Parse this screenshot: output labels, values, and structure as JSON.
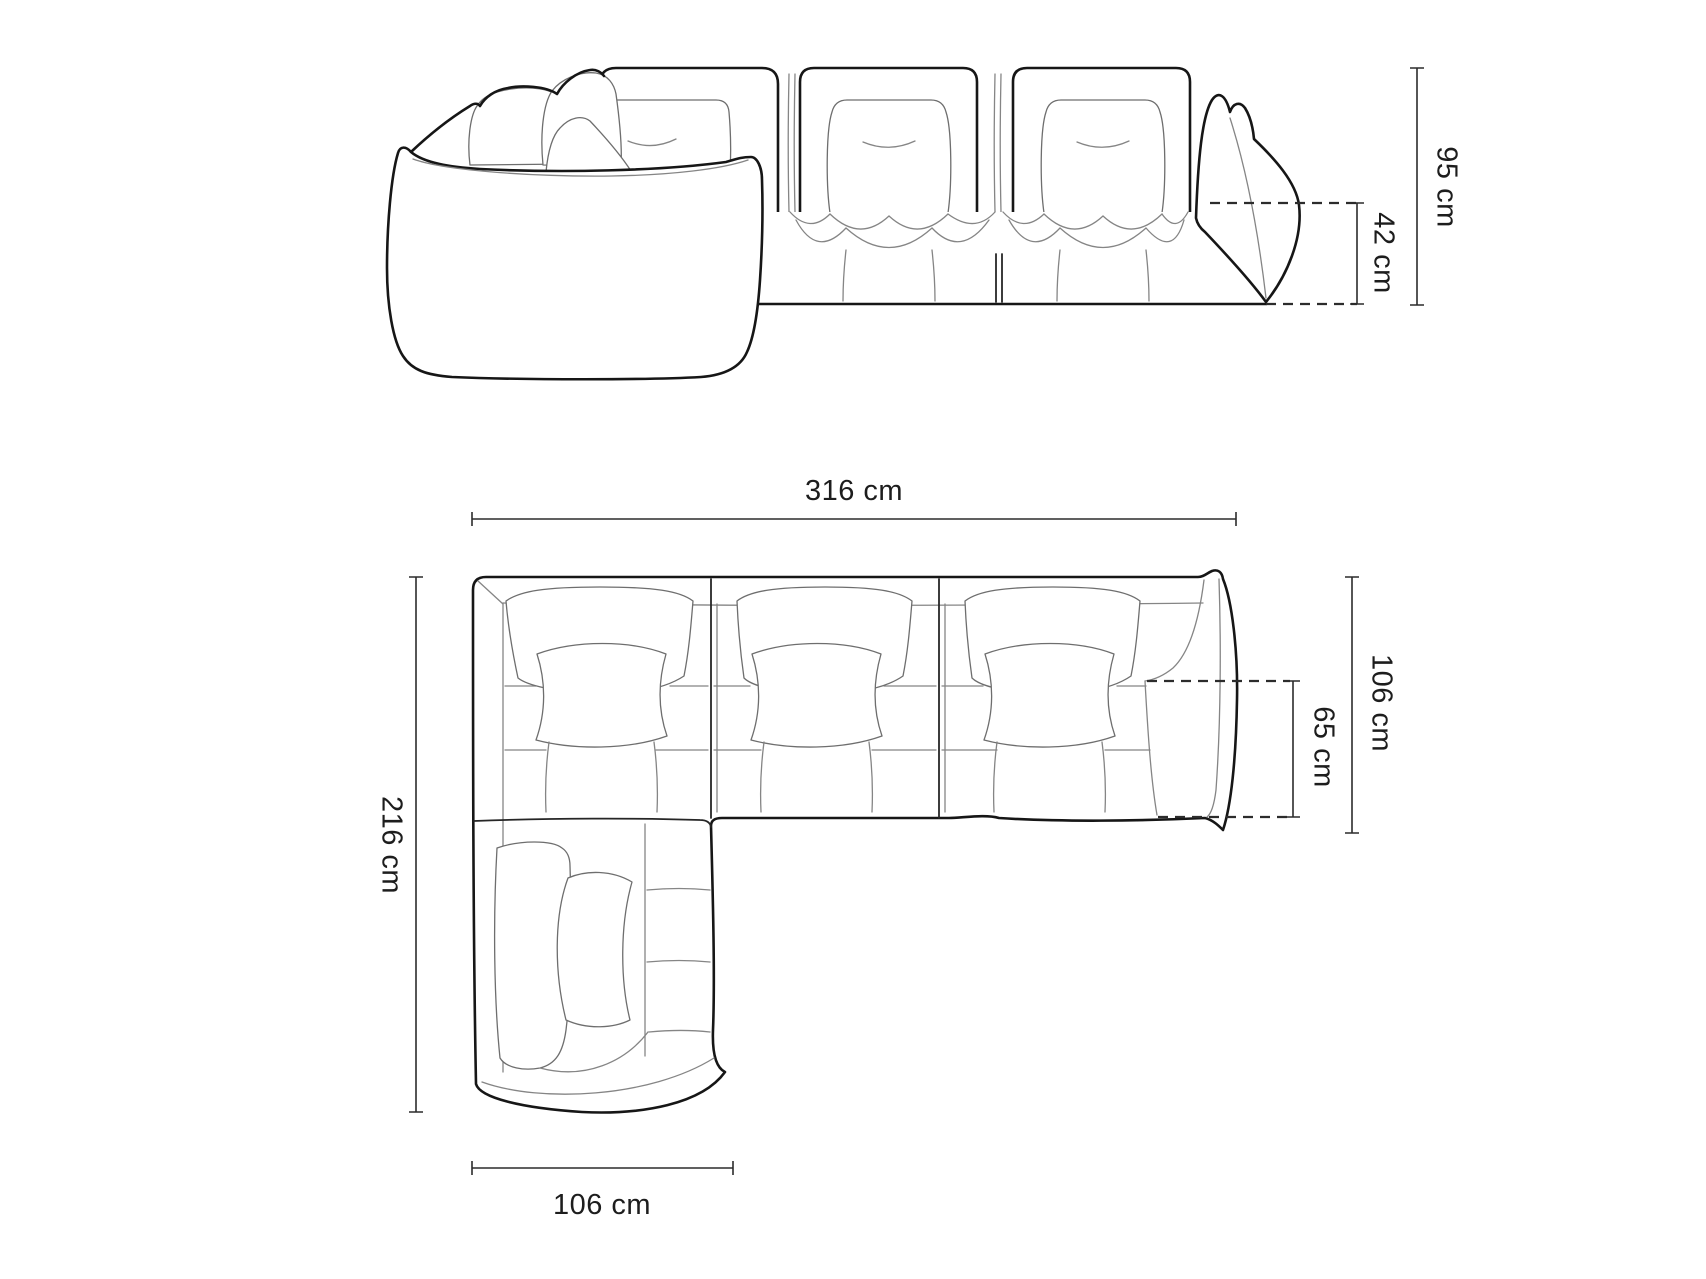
{
  "page": {
    "background": "#ffffff",
    "description": "Line-art dimension diagram of a modular corner sofa, front elevation above and top plan view below"
  },
  "colors": {
    "outline": "#161616",
    "detail_line": "#858585",
    "dimension_line": "#2c2c2c",
    "label_text": "#1d1d1d",
    "background": "#ffffff"
  },
  "views": {
    "front": {
      "name": "front-elevation"
    },
    "top": {
      "name": "top-plan"
    }
  },
  "dimensions": {
    "total_height": "95 cm",
    "seat_height": "42 cm",
    "total_width": "316 cm",
    "total_depth": "216 cm",
    "module_depth": "106 cm",
    "seat_depth": "65 cm",
    "chaise_width": "106 cm"
  }
}
